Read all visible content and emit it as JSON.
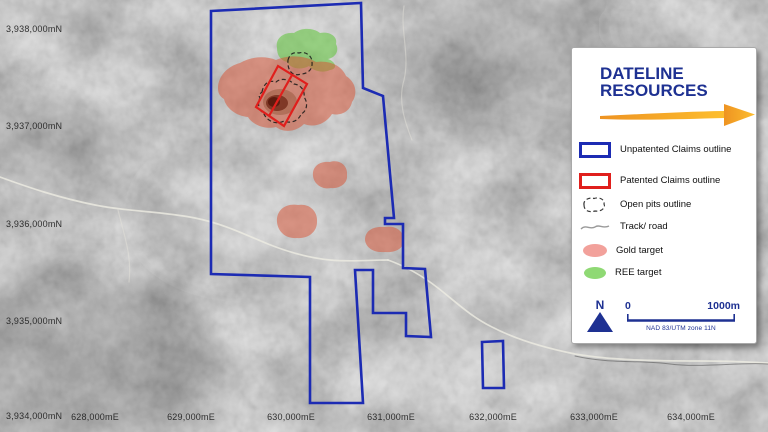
{
  "map": {
    "y_labels": [
      "3,938,000mN",
      "3,937,000mN",
      "3,936,000mN",
      "3,935,000mN",
      "3,934,000mN"
    ],
    "x_labels": [
      "628,000mE",
      "629,000mE",
      "630,000mE",
      "631,000mE",
      "632,000mE",
      "633,000mE",
      "634,000mE"
    ]
  },
  "legend": {
    "brand_line1": "DATELINE",
    "brand_line2": "RESOURCES",
    "items": [
      {
        "icon": "unpatented-claims-swatch",
        "label": "Unpatented Claims outline"
      },
      {
        "icon": "patented-claims-swatch",
        "label": "Patented Claims outline"
      },
      {
        "icon": "open-pits-swatch",
        "label": "Open pits outline"
      },
      {
        "icon": "track-road-swatch",
        "label": "Track/ road"
      },
      {
        "icon": "gold-target-swatch",
        "label": "Gold target"
      },
      {
        "icon": "ree-target-swatch",
        "label": "REE target"
      }
    ],
    "north": "N",
    "scale_start": "0",
    "scale_end": "1000m",
    "datum": "NAD 83/UTM zone 11N"
  },
  "colors": {
    "claim-blue": "#1c2bb3",
    "claim-red": "#e01f1c",
    "gold-target": "#d94f30",
    "ree-green": "#5dc437",
    "brand-navy": "#1e3192",
    "arrow-gold": "#f6a41c",
    "legend-gold-swatch": "#f2a19b",
    "legend-green-swatch": "#8fd974"
  }
}
